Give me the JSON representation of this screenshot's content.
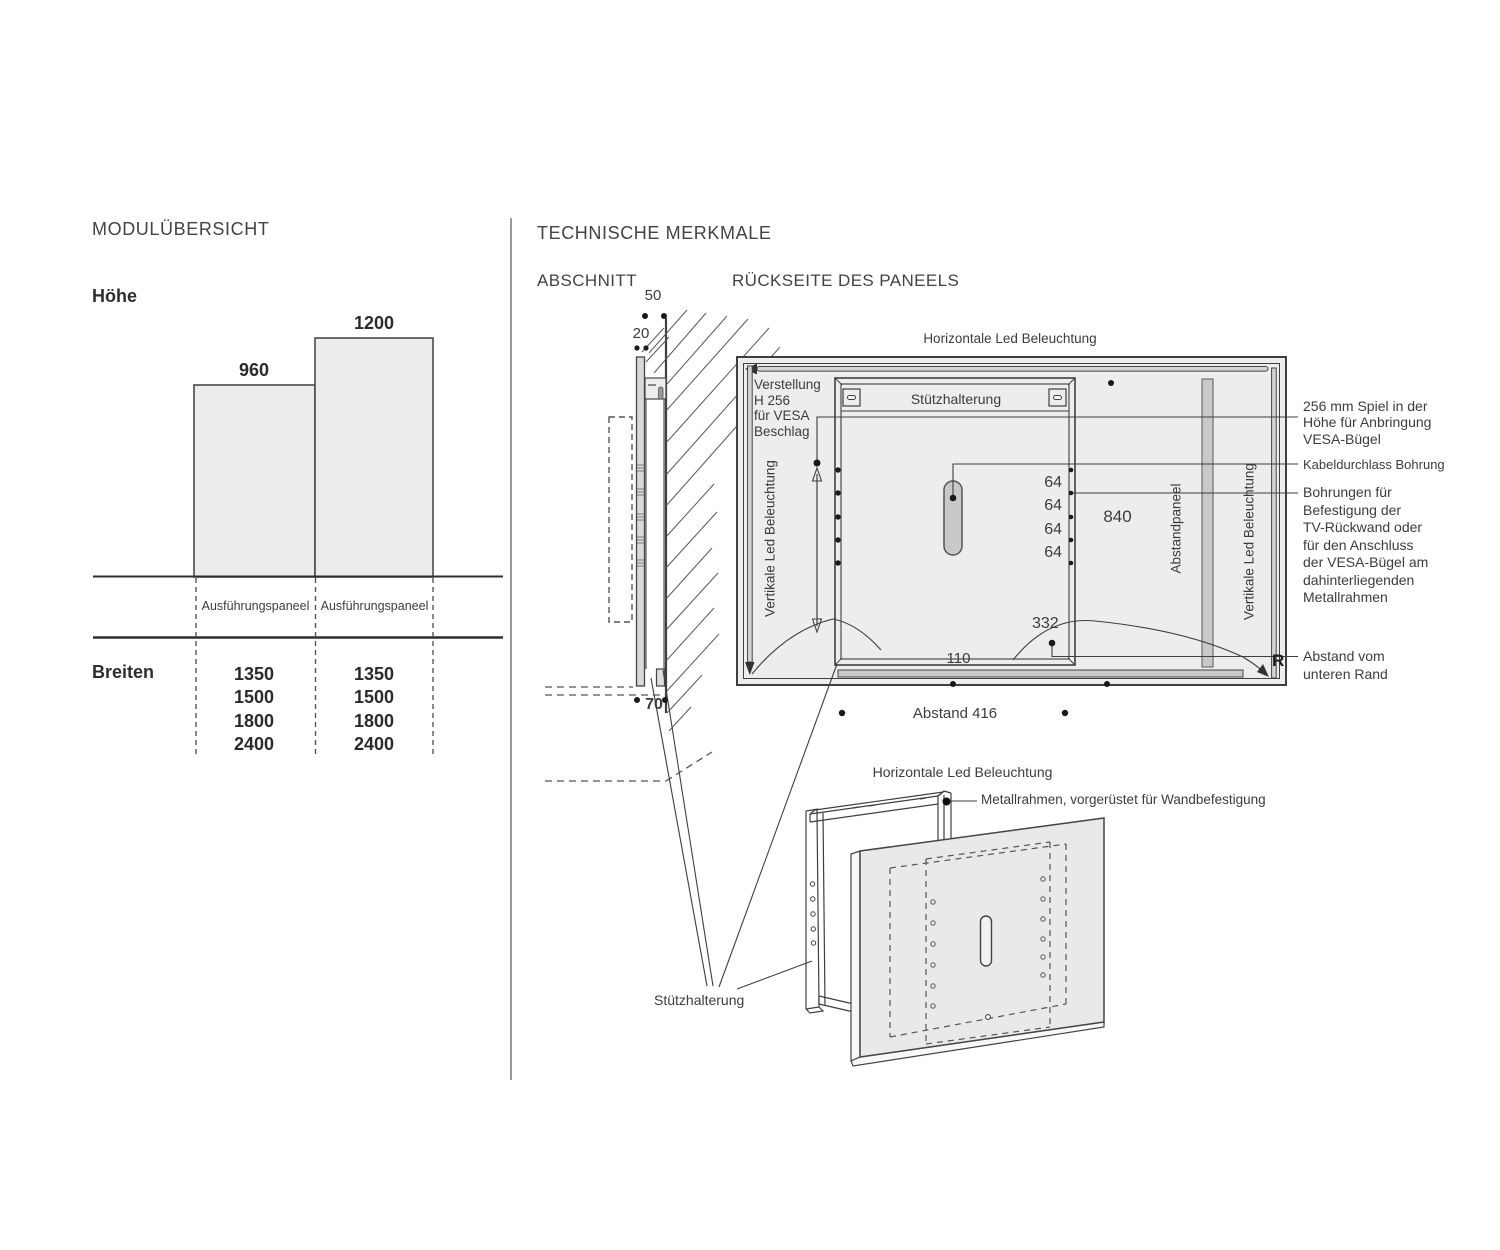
{
  "colors": {
    "line": "#3f3f3f",
    "panel_fill": "#ededed",
    "bar_fill": "#ececec",
    "gray_fill": "#c9c9c9",
    "text": "#3c3c3c"
  },
  "module_overview": {
    "title": "MODULÜBERSICHT",
    "height_label": "Höhe",
    "bar_small_value": "960",
    "bar_large_value": "1200",
    "col1_header": "Ausführungspaneel",
    "col2_header": "Ausführungspaneel",
    "widths_label": "Breiten",
    "widths_col1": "1350\n1500\n1800\n2400",
    "widths_col2": "1350\n1500\n1800\n2400"
  },
  "technical": {
    "title": "TECHNISCHE MERKMALE",
    "section": {
      "title": "ABSCHNITT",
      "dim_top": "50",
      "dim_mid": "20",
      "dim_bottom": "70"
    },
    "rear": {
      "title": "RÜCKSEITE DES PANEELS",
      "horizontal_led": "Horizontale Led Beleuchtung",
      "adjustment_note": "Verstellung\nH 256\nfür VESA\nBeschlag",
      "support_bracket": "Stützhalterung",
      "vertical_led_left": "Vertikale Led Beleuchtung",
      "vertical_led_right": "Vertikale Led Beleuchtung",
      "spacer_panel": "Abstandpaneel",
      "hole_spacing": "64\n64\n64\n64",
      "dim_840": "840",
      "dim_332": "332",
      "dim_110": "110",
      "bottom_distance": "Abstand 416",
      "corner_mark": "R"
    },
    "annotations": {
      "vesa_play": "256 mm Spiel in der\nHöhe für Anbringung\nVESA-Bügel",
      "cable_hole": "Kabeldurchlass Bohrung",
      "mount_holes": "Bohrungen für\nBefestigung der\nTV-Rückwand oder\nfür den Anschluss\nder VESA-Bügel am\ndahinterliegenden\nMetallrahmen",
      "bottom_edge": "Abstand vom\nunteren Rand"
    },
    "exploded": {
      "horizontal_led": "Horizontale Led Beleuchtung",
      "metal_frame": "Metallrahmen, vorgerüstet für Wandbefestigung",
      "support_bracket": "Stützhalterung"
    }
  }
}
